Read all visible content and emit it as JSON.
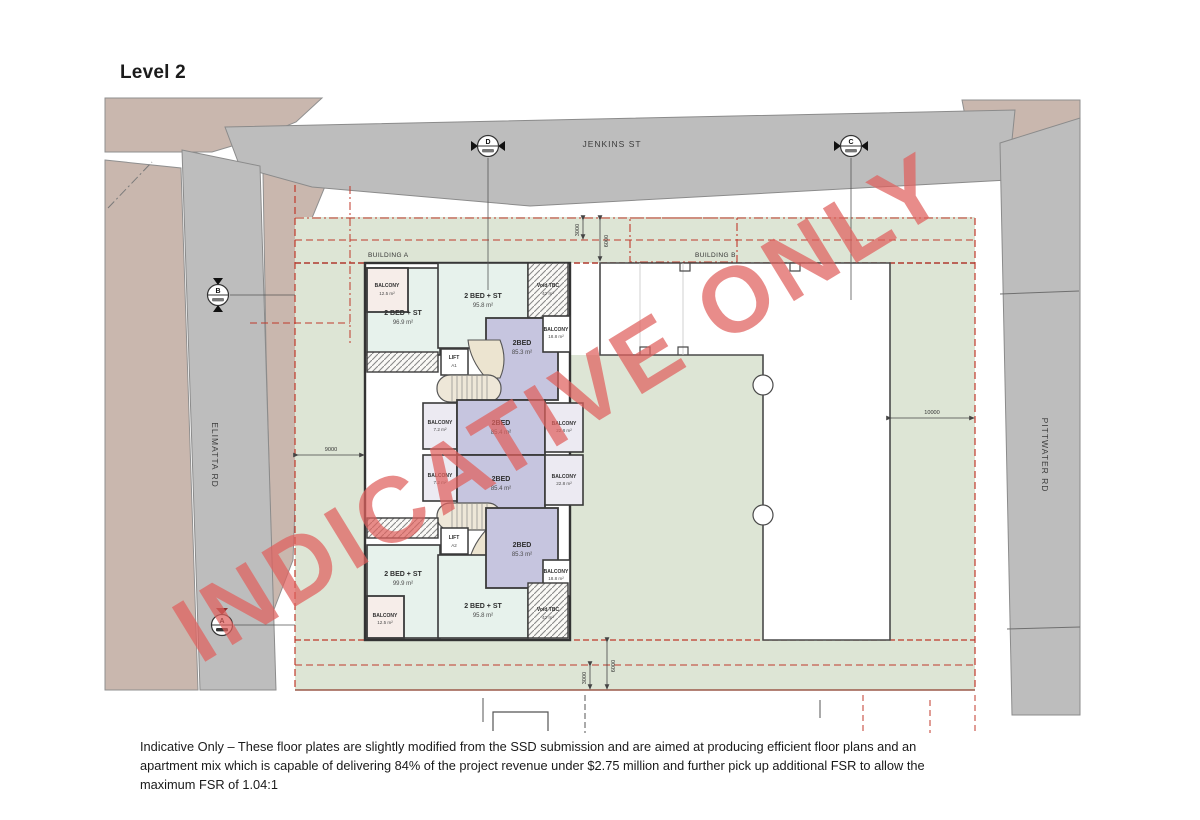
{
  "title": "Level 2",
  "roads": {
    "top": "JENKINS ST",
    "left": "ELIMATTA RD",
    "right": "PITTWATER RD"
  },
  "buildings": {
    "a": "BUILDING A",
    "b": "BUILDING B"
  },
  "grid": {
    "d": "D",
    "c": "C",
    "b": "B",
    "a": "A"
  },
  "units": {
    "bal_tl": {
      "name": "BALCONY",
      "area": "12.5 m²"
    },
    "apt_tl": {
      "name": "2 BED + ST",
      "area": "96.9 m²"
    },
    "apt_tm": {
      "name": "2 BED + ST",
      "area": "95.8 m²"
    },
    "void_tr": {
      "name": "Void TBC",
      "area": "42 m²"
    },
    "apt_2bed_top": {
      "name": "2BED",
      "area": "85.3 m²"
    },
    "bal_tr": {
      "name": "BALCONY",
      "area": "18.8 m²"
    },
    "lift_a1": {
      "name": "LIFT",
      "area": "A1"
    },
    "bal_ml1": {
      "name": "BALCONY",
      "area": "7.2 m²"
    },
    "apt_2bed_m1": {
      "name": "2BED",
      "area": "85.4 m²"
    },
    "bal_mr1": {
      "name": "BALCONY",
      "area": "22.8 m²"
    },
    "bal_ml2": {
      "name": "BALCONY",
      "area": "7.2 m²"
    },
    "apt_2bed_m2": {
      "name": "2BED",
      "area": "85.4 m²"
    },
    "bal_mr2": {
      "name": "BALCONY",
      "area": "22.8 m²"
    },
    "lift_a2": {
      "name": "LIFT",
      "area": "A2"
    },
    "apt_2bed_bot": {
      "name": "2BED",
      "area": "85.3 m²"
    },
    "bal_br": {
      "name": "BALCONY",
      "area": "18.8 m²"
    },
    "apt_bl": {
      "name": "2 BED + ST",
      "area": "99.9 m²"
    },
    "bal_bl": {
      "name": "BALCONY",
      "area": "12.5 m²"
    },
    "apt_bm": {
      "name": "2 BED + ST",
      "area": "95.8 m²"
    },
    "void_br": {
      "name": "Void TBC",
      "area": "42 m²"
    }
  },
  "dimensions": {
    "top_3000": "3000",
    "top_6000": "6000",
    "left_9000": "9000",
    "right_10000": "10000",
    "bottom_3000": "3000",
    "bottom_6000": "6000"
  },
  "watermark": "INDICATIVE ONLY",
  "caption": "Indicative Only – These floor plates are slightly modified from the SSD submission and are aimed at producing efficient floor plans and an apartment mix which is capable of delivering 84% of the project revenue under $2.75 million and further pick up additional FSR to allow the maximum FSR of 1.04:1",
  "colors": {
    "road": "#bdbdbd",
    "land": "#c9b7ae",
    "site_green": "#dde5d5",
    "unit_mint": "#e7f2ec",
    "unit_purple": "#c6c5df",
    "lobby_cream": "#ece4d0",
    "setback_red": "#c0392b",
    "watermark_red": "#e0615e"
  }
}
